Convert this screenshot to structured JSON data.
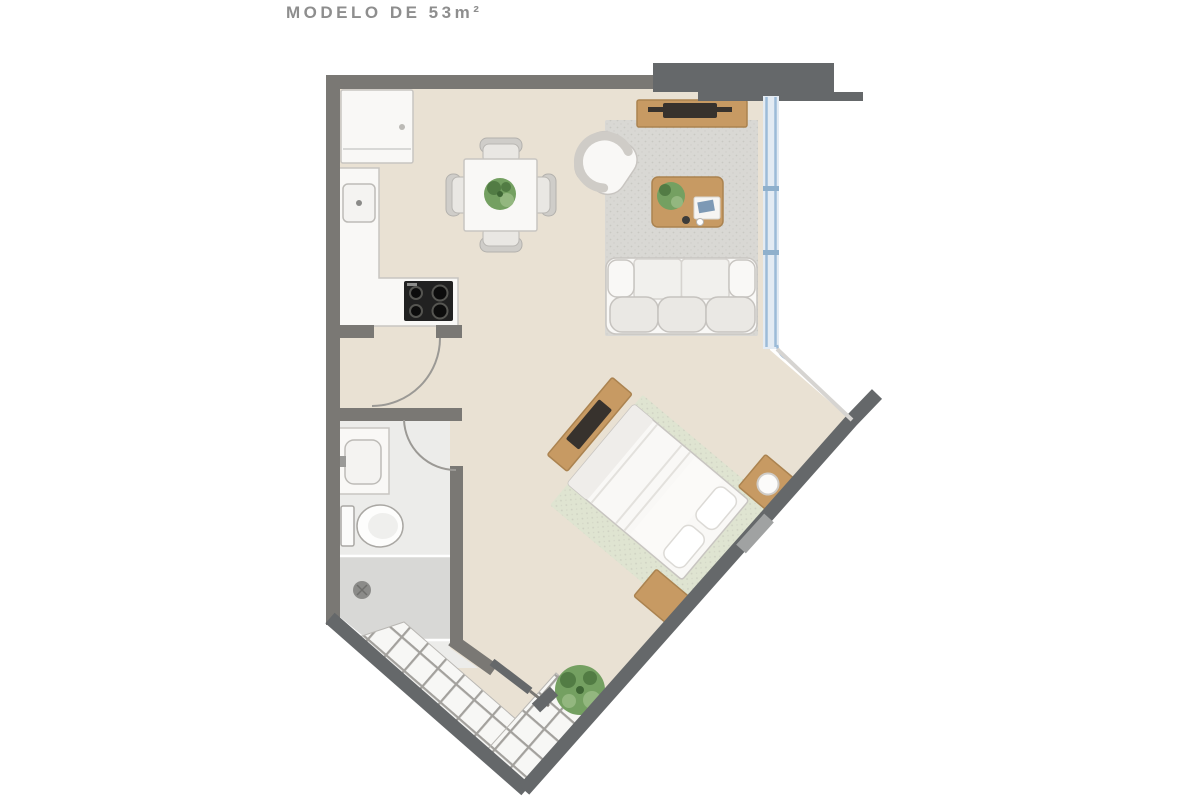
{
  "title": {
    "text": "MODELO DE 53m²"
  },
  "colors": {
    "bg": "#ffffff",
    "title": "#8e8e8e",
    "floor": "#e9e1d3",
    "bath-floor": "#ececea",
    "shower": "#d8d8d6",
    "wall": "#7a7874",
    "wall-dark": "#65686a",
    "wall-light": "#a0a2a2",
    "arc": "#9b9995",
    "thin-edge": "#d6d4d1",
    "tile-fill": "#f7f7f5",
    "tile-grout": "#a3a19d",
    "tile-outline": "#b9b7b3",
    "rug": "#d9d8d4",
    "rug-bed": "#dfe4d1",
    "wood": "#c79a63",
    "wood-dark": "#ab8350",
    "tv": "#37322d",
    "white-furn": "#f9f8f6",
    "furn-stroke": "#c8c5c1",
    "stove": "#212121",
    "window-frame": "#e3ebf3",
    "window-line": "#9cbbd8",
    "window-tick": "#8fb0cc",
    "green": "#74a061",
    "green-dark": "#527c44",
    "green-light": "#93b77f",
    "drain": "#8b8b89"
  },
  "plan": {
    "items": [
      "fridge-icon",
      "kitchen-counter",
      "kitchen-sink-icon",
      "stove-icon",
      "dining-table",
      "dining-chair-icon",
      "centerpiece-plant-icon",
      "tv-console",
      "tv-icon",
      "armchair-icon",
      "living-rug",
      "coffee-table",
      "sofa-icon",
      "window-glazing",
      "bedroom-rug",
      "bed-icon",
      "pillow-icon",
      "nightstand-icon",
      "lamp-icon",
      "dresser-icon",
      "vanity-icon",
      "toilet-icon",
      "shower-icon",
      "drain-icon",
      "entry-tiles",
      "entry-door-leaf",
      "door-swing-arc",
      "entry-plant-icon"
    ]
  }
}
